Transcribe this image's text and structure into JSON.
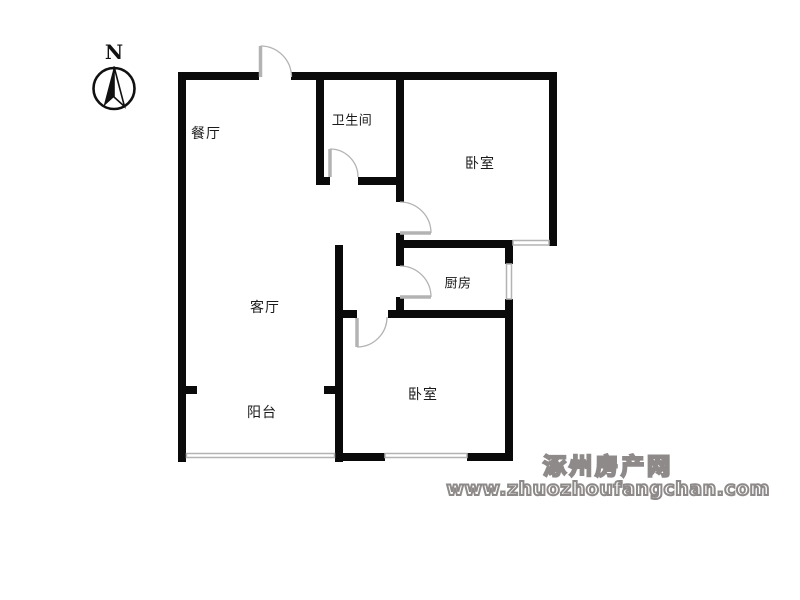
{
  "compass": {
    "north_label": "N"
  },
  "rooms": {
    "dining": {
      "label": "餐厅"
    },
    "bathroom": {
      "label": "卫生间"
    },
    "bedroom_top": {
      "label": "卧室"
    },
    "kitchen": {
      "label": "厨房"
    },
    "living": {
      "label": "客厅"
    },
    "balcony": {
      "label": "阳台"
    },
    "bedroom_bottom": {
      "label": "卧室"
    }
  },
  "watermark": {
    "site_name": "涿州房产网",
    "site_url": "www.zhuozhoufangchan.com"
  },
  "colors": {
    "wall": "#0a0a0a",
    "door_window_gray": "#b3b3b3",
    "label_text": "#1a1a1a",
    "watermark_gray": "#8f8a8a",
    "background": "#ffffff"
  }
}
